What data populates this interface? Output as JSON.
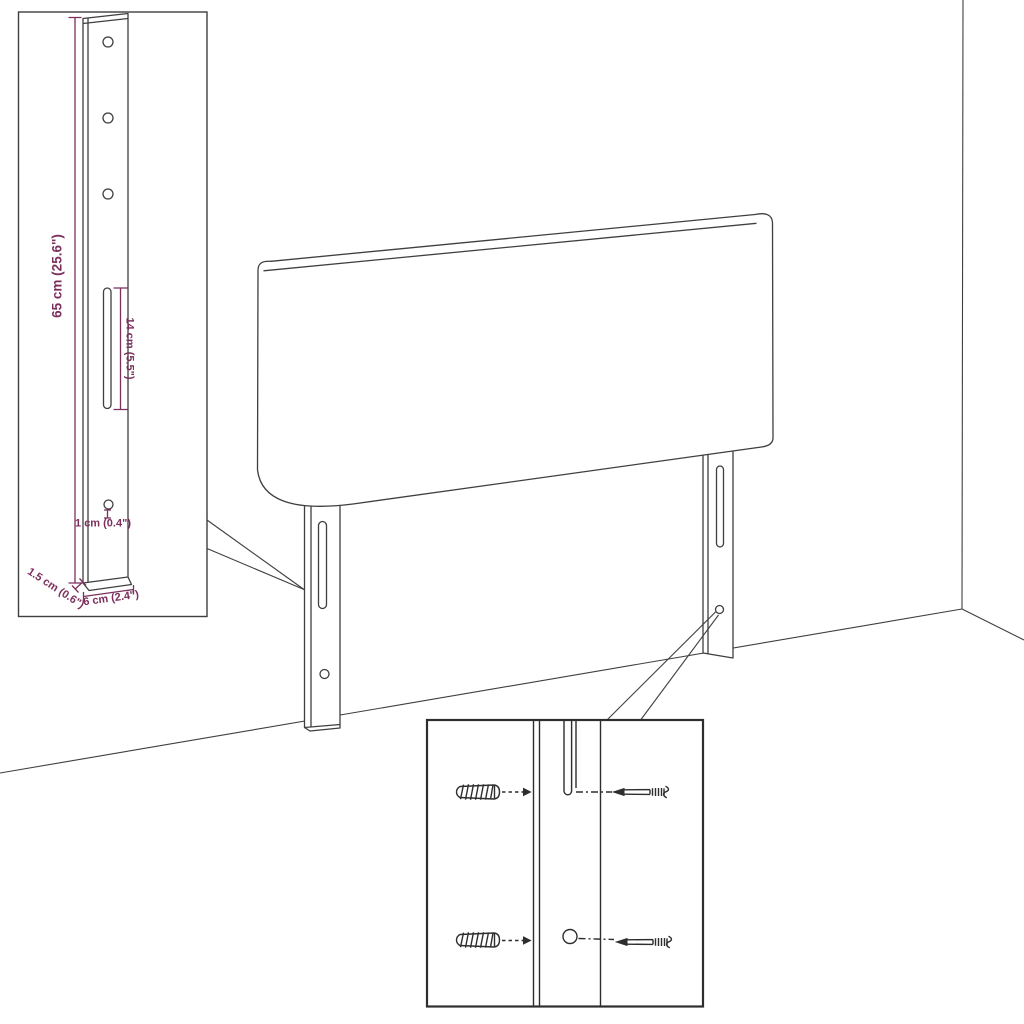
{
  "colors": {
    "line": "#3f3f3f",
    "hardware": "#2e2e2e",
    "dimension": "#7b2f5d",
    "background": "#ffffff"
  },
  "illustration": {
    "subject": "headboard-with-mounting-legs-assembly-diagram",
    "scene": {
      "elements": [
        "room-corner-lines",
        "headboard-panel",
        "mounting-leg-left",
        "mounting-leg-right"
      ]
    },
    "bracket_inset": {
      "depicts": "mounting-leg-bracket-detail",
      "dimensions": {
        "bracket_height": "65 cm (25.6\")",
        "slot_length": "14 cm (5.5\")",
        "hole_diameter": "1 cm (0.4\")",
        "bracket_thickness": "1.5 cm (0.6\")",
        "bracket_width": "6 cm (2.4\")"
      }
    },
    "hardware_inset": {
      "depicts": "wall-mounting-hardware-detail",
      "hardware": [
        "wall-plug",
        "screw",
        "wall-plug",
        "screw"
      ]
    }
  }
}
